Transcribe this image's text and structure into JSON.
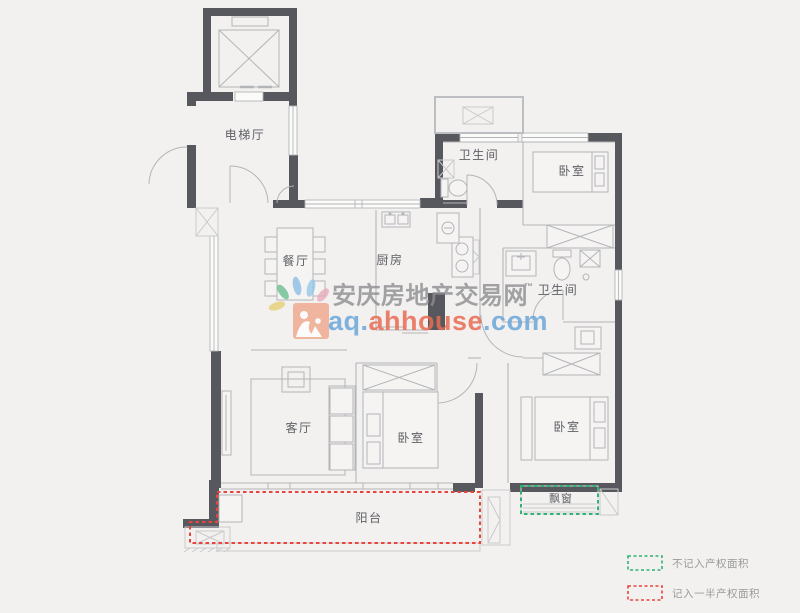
{
  "colors": {
    "bg": "#f2f1f0",
    "wall": "#57585d",
    "line": "#b4b5b8",
    "lightline": "#c9cacc",
    "text": "#5f6066",
    "red": "#e8453f",
    "green": "#2fb374",
    "legendText": "#9a9a9b",
    "wmGray": "#8d8d90",
    "wmBlue": "#6ba6da",
    "wmOrange": "#ea6b52",
    "logoOrange": "#f0a184"
  },
  "rooms": {
    "elevator_hall": "电梯厅",
    "bathroom_top": "卫生间",
    "bedroom_top": "卧室",
    "dining": "餐厅",
    "kitchen": "厨房",
    "bathroom_mid": "卫生间",
    "living": "客厅",
    "bedroom_mid": "卧室",
    "bedroom_right": "卧室",
    "balcony": "阳台",
    "bay_window": "飘窗"
  },
  "watermark": {
    "site_name": "安庆房地产交易网",
    "tm": "™",
    "url_prefix": "aq.",
    "url_mid": "ahhouse",
    "url_suffix": ".com"
  },
  "legend": {
    "not_counted": "不记入产权面积",
    "half_counted": "记入一半产权面积"
  }
}
